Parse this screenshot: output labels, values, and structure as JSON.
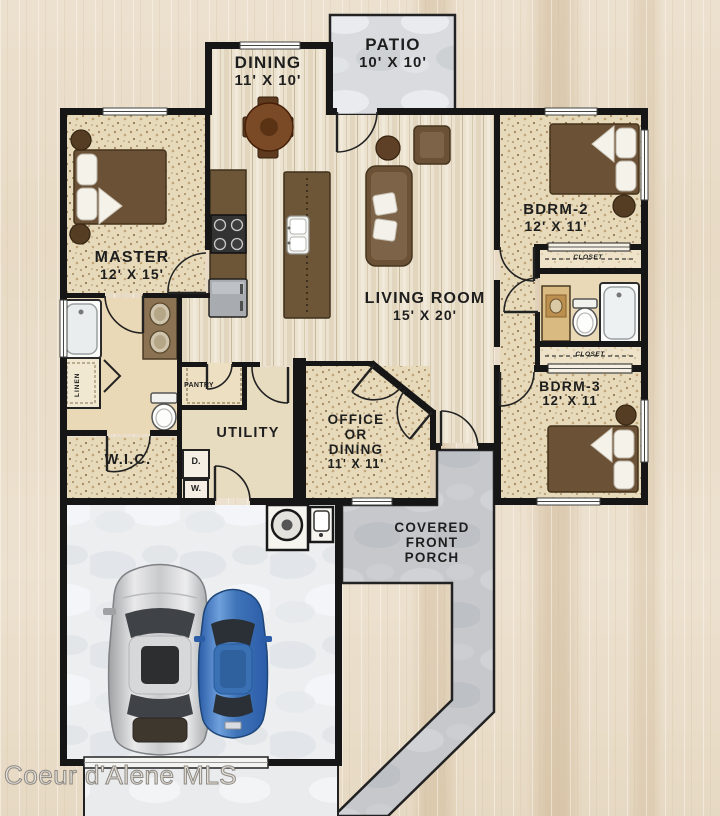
{
  "watermark": "Coeur d'Alene MLS",
  "rooms": {
    "patio": {
      "name": "PATIO",
      "dims": "10' X 10'"
    },
    "dining": {
      "name": "DINING",
      "dims": "11' X 10'"
    },
    "master": {
      "name": "MASTER",
      "dims": "12' X 15'"
    },
    "bdrm2": {
      "name": "BDRM-2",
      "dims": "12' X 11'"
    },
    "living": {
      "name": "LIVING ROOM",
      "dims": "15' X 20'"
    },
    "bdrm3": {
      "name": "BDRM-3",
      "dims": "12' X 11"
    },
    "wic": {
      "name": "W.I.C."
    },
    "utility": {
      "name": "UTILITY"
    },
    "office": {
      "line1": "OFFICE",
      "line2": "OR",
      "line3": "DINING",
      "dims": "11' X 11'"
    },
    "porch": {
      "line1": "COVERED",
      "line2": "FRONT",
      "line3": "PORCH"
    }
  },
  "fixtures": {
    "closet_bdrm2": "CLOSET",
    "closet_bdrm3": "CLOSET",
    "linen": "LINEN",
    "pantry": "PANTRY",
    "dryer": "D.",
    "washer": "W."
  },
  "colors": {
    "label": "#1e1e1e",
    "watermark": "#e4e0d9",
    "wall": "#161616",
    "plank_floor": "#ebe2cf",
    "speckle_floor": "#e6dabb",
    "bath_floor": "#ead9b6",
    "porch_concrete": "#c6c8cc",
    "garage_concrete": "#eceef0",
    "furniture_brown": "#6b5136",
    "table_brown": "#7a4a26",
    "car_silver": "#c9cacc",
    "car_blue": "#3f74b8"
  }
}
